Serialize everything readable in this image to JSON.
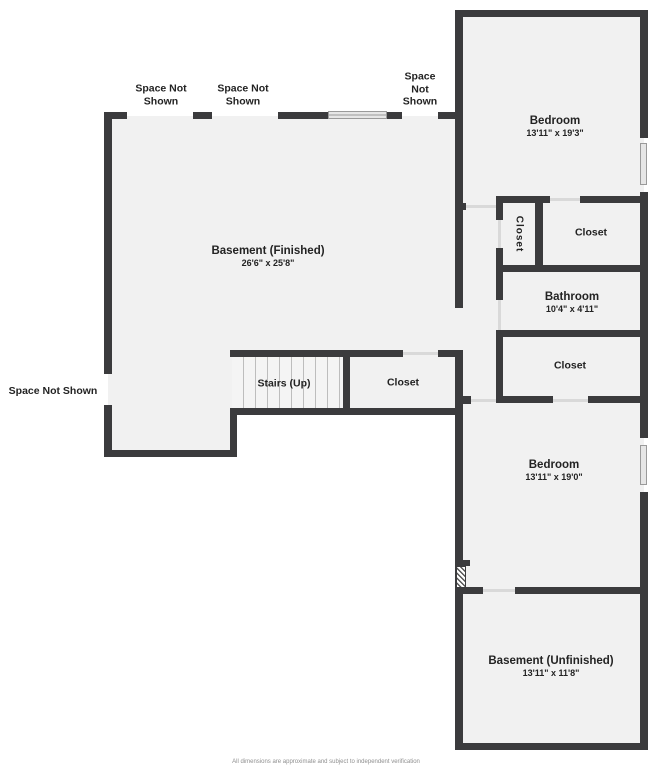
{
  "plan": {
    "rooms": {
      "basement_finished": {
        "name": "Basement (Finished)",
        "dims": "26'6\" x 25'8\""
      },
      "bedroom_upper": {
        "name": "Bedroom",
        "dims": "13'11\" x 19'3\""
      },
      "closet_small_vertical": {
        "name": "Closet"
      },
      "closet_upper": {
        "name": "Closet"
      },
      "bathroom": {
        "name": "Bathroom",
        "dims": "10'4\" x 4'11\""
      },
      "closet_mid": {
        "name": "Closet"
      },
      "stairs": {
        "name": "Stairs (Up)"
      },
      "closet_stairs": {
        "name": "Closet"
      },
      "bedroom_lower": {
        "name": "Bedroom",
        "dims": "13'11\" x 19'0\""
      },
      "basement_unfinished": {
        "name": "Basement (Unfinished)",
        "dims": "13'11\" x 11'8\""
      }
    },
    "annotations": {
      "space_not_shown": "Space Not Shown"
    },
    "footer": {
      "disclaimer": "All dimensions are approximate and subject to independent verification"
    },
    "colors": {
      "wall": "#3b3b3d",
      "floor": "#f1f1f1",
      "window_fill": "#e6e6e6",
      "window_border": "#9a9a9a",
      "door_line": "#d9d9d9",
      "stair_tread": "#bdbdbd",
      "text": "#232323",
      "disclaimer_text": "#8f8f8f"
    }
  }
}
